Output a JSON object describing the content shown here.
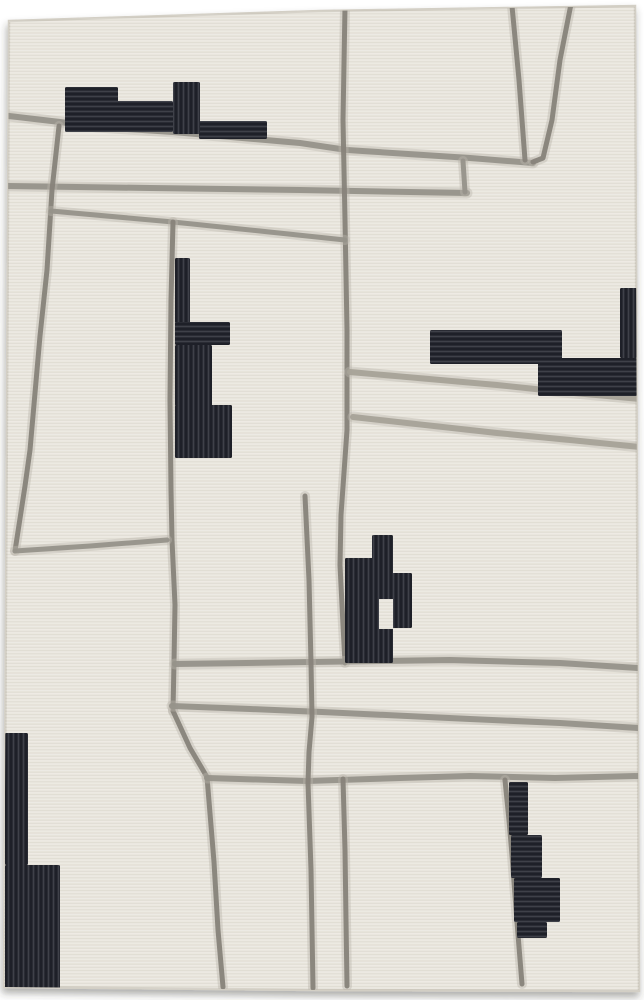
{
  "canvas": {
    "width": 644,
    "height": 1000,
    "background": "#ffffff"
  },
  "subject": "abstract-area-rug-photograph",
  "palette": {
    "rug_base": "#eae7df",
    "rug_edge": "#d3cfc5",
    "shadow": "rgba(55,52,47,0.40)",
    "line_dark": "#87837a",
    "line_mid": "#96928a",
    "line_light": "#a6a298",
    "line_halo": "#bab6ac",
    "block_black": "#25272f",
    "weave_row": "rgba(135,127,112,0.10)",
    "weave_hi": "rgba(255,255,255,0.20)",
    "rib_hi": "rgba(220,224,235,0.14)",
    "rib_lo": "rgba(5,6,10,0.35)"
  },
  "rug": {
    "outline": [
      [
        9,
        21
      ],
      [
        320,
        11
      ],
      [
        635,
        6
      ],
      [
        637,
        500
      ],
      [
        639,
        991
      ],
      [
        320,
        990
      ],
      [
        4,
        987
      ]
    ]
  },
  "lines": [
    {
      "name": "top-long-diagonal",
      "shade": "mid",
      "width": 6,
      "points": [
        [
          9,
          116
        ],
        [
          60,
          122
        ],
        [
          97,
          127
        ],
        [
          173,
          132
        ],
        [
          300,
          143
        ],
        [
          347,
          150
        ],
        [
          470,
          158
        ],
        [
          533,
          163
        ]
      ]
    },
    {
      "name": "second-horizontal",
      "shade": "mid",
      "width": 6,
      "points": [
        [
          8,
          186
        ],
        [
          150,
          188
        ],
        [
          300,
          190
        ],
        [
          467,
          193
        ]
      ]
    },
    {
      "name": "horizontal-connector",
      "shade": "mid",
      "width": 5,
      "points": [
        [
          465,
          192
        ],
        [
          463,
          161
        ]
      ]
    },
    {
      "name": "top-v-left",
      "shade": "dark",
      "width": 5,
      "points": [
        [
          512,
          6
        ],
        [
          519,
          80
        ],
        [
          525,
          160
        ]
      ]
    },
    {
      "name": "top-v-right",
      "shade": "dark",
      "width": 5,
      "points": [
        [
          571,
          4
        ],
        [
          560,
          60
        ],
        [
          552,
          120
        ],
        [
          543,
          158
        ],
        [
          533,
          162
        ]
      ]
    },
    {
      "name": "upper-center-vertical",
      "shade": "dark",
      "width": 5,
      "points": [
        [
          345,
          7
        ],
        [
          343,
          120
        ],
        [
          345,
          220
        ],
        [
          347,
          330
        ],
        [
          347,
          430
        ],
        [
          341,
          515
        ],
        [
          340,
          565
        ],
        [
          343,
          625
        ],
        [
          345,
          663
        ]
      ]
    },
    {
      "name": "left-vertical",
      "shade": "dark",
      "width": 5,
      "points": [
        [
          59,
          126
        ],
        [
          52,
          190
        ],
        [
          47,
          270
        ],
        [
          40,
          336
        ],
        [
          30,
          450
        ],
        [
          25,
          486
        ],
        [
          15,
          551
        ]
      ]
    },
    {
      "name": "left-diagonal",
      "shade": "mid",
      "width": 5,
      "points": [
        [
          51,
          211
        ],
        [
          173,
          222
        ],
        [
          260,
          231
        ],
        [
          345,
          240
        ]
      ]
    },
    {
      "name": "center-vertical",
      "shade": "dark",
      "width": 5,
      "points": [
        [
          173,
          222
        ],
        [
          171,
          300
        ],
        [
          170,
          400
        ],
        [
          171,
          490
        ],
        [
          172,
          540
        ],
        [
          175,
          605
        ],
        [
          174,
          662
        ],
        [
          173,
          711
        ]
      ]
    },
    {
      "name": "center-bend-diagonal",
      "shade": "dark",
      "width": 5,
      "points": [
        [
          173,
          711
        ],
        [
          190,
          748
        ],
        [
          207,
          777
        ],
        [
          214,
          862
        ],
        [
          218,
          930
        ],
        [
          223,
          987
        ]
      ]
    },
    {
      "name": "lower-left-diagonal",
      "shade": "mid",
      "width": 5,
      "points": [
        [
          15,
          551
        ],
        [
          90,
          546
        ],
        [
          167,
          540
        ]
      ]
    },
    {
      "name": "mid-horizontal-663",
      "shade": "mid",
      "width": 6,
      "points": [
        [
          175,
          664
        ],
        [
          310,
          662
        ],
        [
          450,
          660
        ],
        [
          560,
          663
        ],
        [
          638,
          668
        ]
      ]
    },
    {
      "name": "mid-horizontal-713",
      "shade": "mid",
      "width": 6,
      "points": [
        [
          172,
          706
        ],
        [
          250,
          709
        ],
        [
          322,
          712
        ],
        [
          470,
          719
        ],
        [
          560,
          723
        ],
        [
          638,
          728
        ]
      ]
    },
    {
      "name": "mid-horizontal-777",
      "shade": "mid",
      "width": 6,
      "points": [
        [
          207,
          778
        ],
        [
          307,
          781
        ],
        [
          400,
          778
        ],
        [
          470,
          776
        ],
        [
          555,
          778
        ],
        [
          638,
          776
        ]
      ]
    },
    {
      "name": "right-diagonal-385",
      "shade": "light",
      "width": 6,
      "points": [
        [
          350,
          372
        ],
        [
          497,
          385
        ],
        [
          563,
          392
        ],
        [
          640,
          399
        ]
      ]
    },
    {
      "name": "right-diagonal-430",
      "shade": "light",
      "width": 6,
      "points": [
        [
          353,
          417
        ],
        [
          497,
          433
        ],
        [
          570,
          440
        ],
        [
          640,
          447
        ]
      ]
    },
    {
      "name": "vertical-306",
      "shade": "dark",
      "width": 5,
      "points": [
        [
          305,
          496
        ],
        [
          309,
          580
        ],
        [
          311,
          663
        ],
        [
          312,
          717
        ],
        [
          309,
          752
        ],
        [
          308,
          783
        ],
        [
          311,
          870
        ],
        [
          313,
          988
        ]
      ]
    },
    {
      "name": "vertical-344-lower",
      "shade": "dark",
      "width": 5,
      "points": [
        [
          343,
          779
        ],
        [
          345,
          850
        ],
        [
          346,
          920
        ],
        [
          347,
          986
        ]
      ]
    },
    {
      "name": "vertical-505-slant",
      "shade": "dark",
      "width": 5,
      "points": [
        [
          505,
          780
        ],
        [
          509,
          820
        ],
        [
          512,
          855
        ],
        [
          517,
          922
        ],
        [
          522,
          984
        ]
      ]
    }
  ],
  "shapes": [
    {
      "name": "top-left-blocks",
      "ribs": "h",
      "rects": [
        [
          65,
          87,
          53,
          16
        ],
        [
          65,
          101,
          108,
          31
        ],
        [
          199,
          121,
          68,
          18
        ]
      ]
    },
    {
      "name": "top-left-column",
      "ribs": "v",
      "rects": [
        [
          173,
          82,
          27,
          52
        ]
      ]
    },
    {
      "name": "left-e-column",
      "ribs": "v",
      "rects": [
        [
          175,
          258,
          15,
          65
        ],
        [
          175,
          345,
          37,
          61
        ],
        [
          175,
          405,
          57,
          53
        ]
      ]
    },
    {
      "name": "left-e-arm",
      "ribs": "h",
      "rects": [
        [
          175,
          322,
          55,
          23
        ]
      ]
    },
    {
      "name": "right-top-bar",
      "ribs": "h",
      "rects": [
        [
          430,
          330,
          132,
          34
        ],
        [
          538,
          358,
          99,
          38
        ]
      ]
    },
    {
      "name": "right-edge-strip",
      "ribs": "v",
      "rects": [
        [
          620,
          288,
          17,
          70
        ]
      ]
    },
    {
      "name": "middle-stairs",
      "ribs": "v",
      "rects": [
        [
          372,
          535,
          21,
          38
        ],
        [
          345,
          558,
          48,
          105
        ],
        [
          392,
          573,
          20,
          55
        ]
      ]
    },
    {
      "name": "bottom-left-blocks",
      "ribs": "v",
      "rects": [
        [
          5,
          733,
          23,
          132
        ],
        [
          5,
          865,
          55,
          127
        ]
      ]
    },
    {
      "name": "bottom-right-stairs",
      "ribs": "h",
      "rects": [
        [
          509,
          782,
          19,
          53
        ],
        [
          511,
          835,
          31,
          43
        ],
        [
          514,
          878,
          46,
          44
        ],
        [
          517,
          922,
          30,
          16
        ]
      ]
    }
  ],
  "cutouts": [
    {
      "name": "middle-stairs-notch",
      "rect": [
        379,
        599,
        14,
        30
      ]
    }
  ]
}
